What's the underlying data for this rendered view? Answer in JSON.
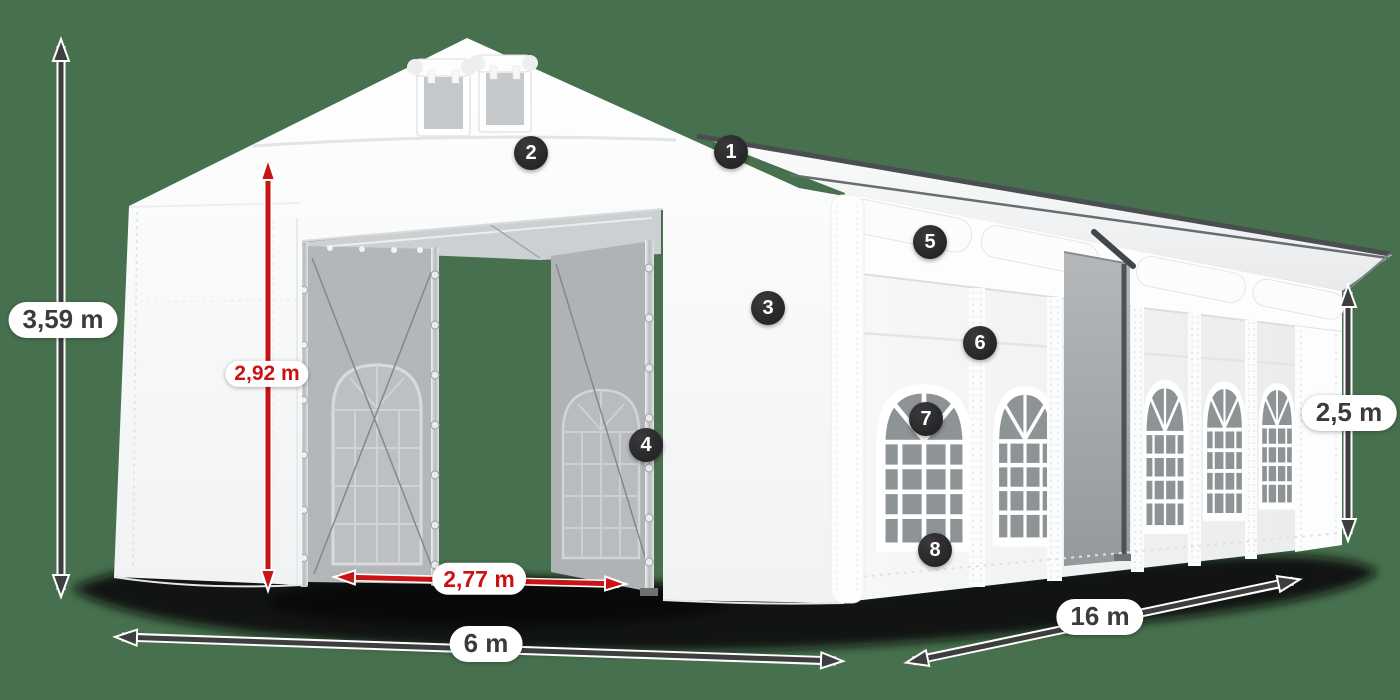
{
  "dimensions": {
    "total_height": "3,59 m",
    "entrance_height": "2,92 m",
    "entrance_width": "2,77 m",
    "width": "6 m",
    "length": "16 m",
    "side_height": "2,5 m"
  },
  "badges": [
    "1",
    "2",
    "3",
    "4",
    "5",
    "6",
    "7",
    "8"
  ],
  "colors": {
    "background": "#47714E",
    "dimension_arrow": "#3e3e3e",
    "highlight_arrow": "#c81414",
    "label_text": "#3b3b3d",
    "highlight_label_text": "#cb1212",
    "badge_background": "#2d2d2f",
    "badge_text": "#ffffff",
    "tent_fabric": "#ffffff",
    "tent_mesh_panel": "#b4b7b9",
    "window_glass": "#8e9396"
  }
}
